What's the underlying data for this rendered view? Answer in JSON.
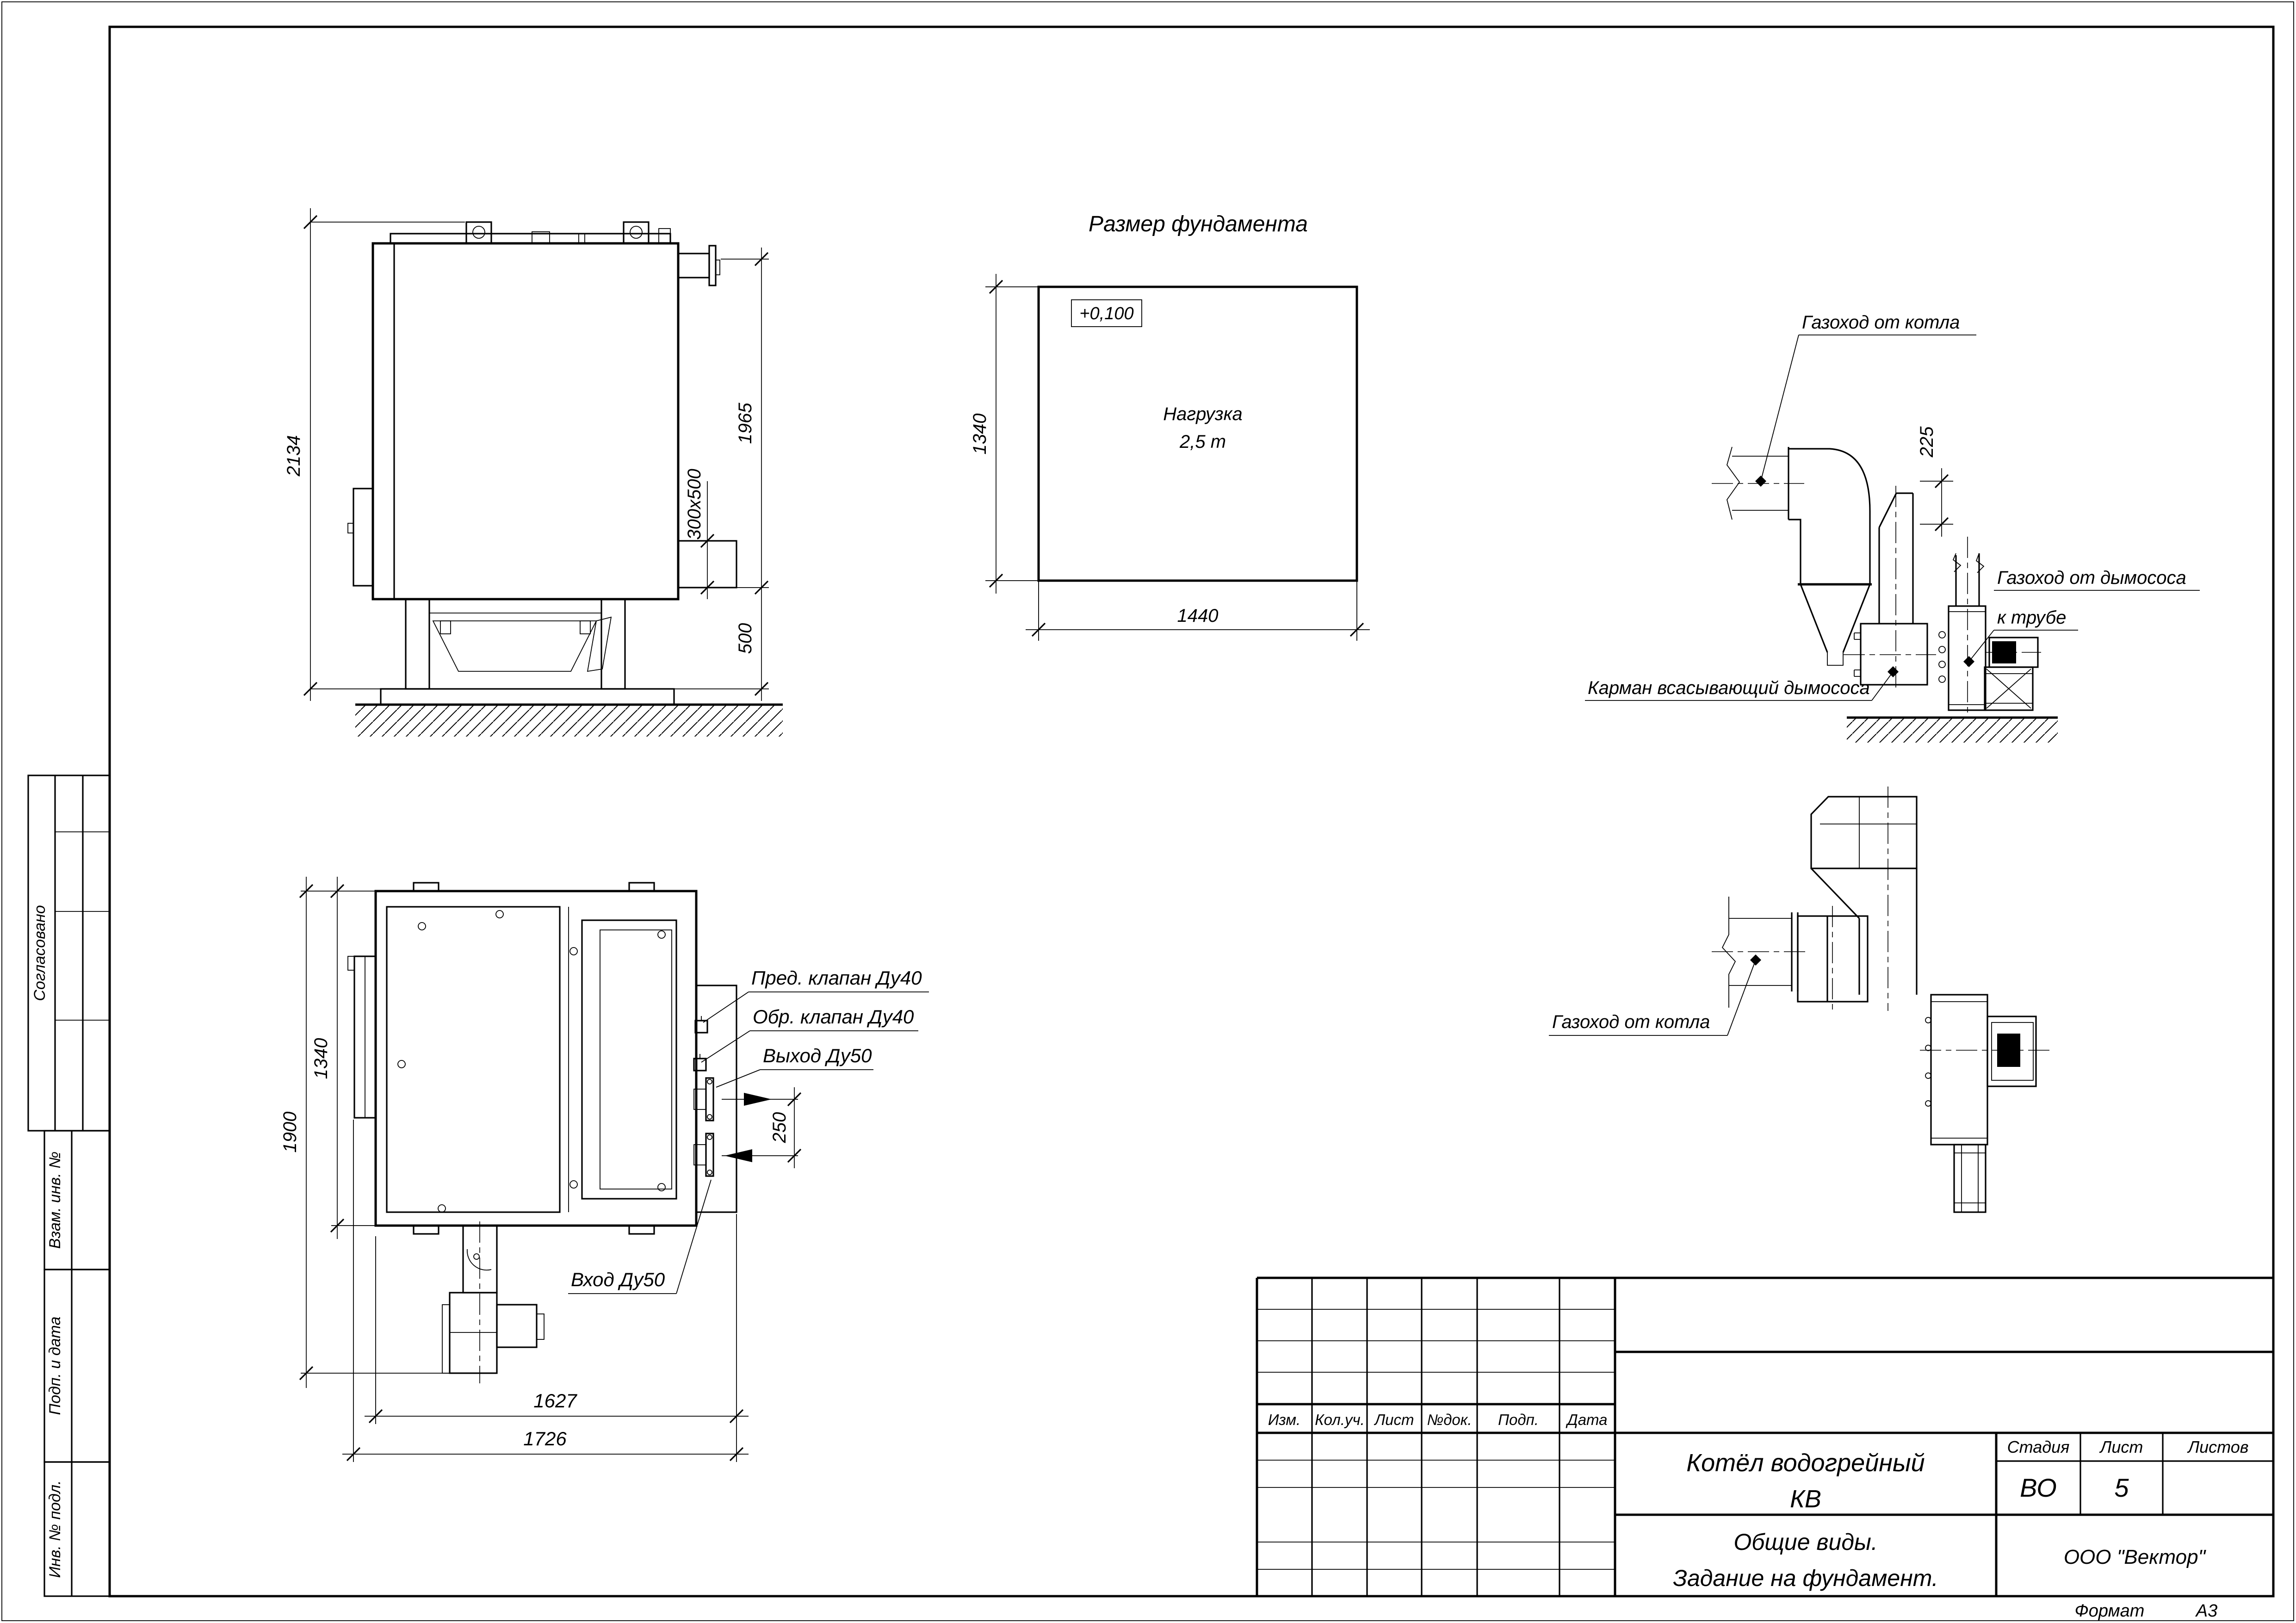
{
  "format": {
    "label": "Формат",
    "value": "А3"
  },
  "side_labels": {
    "approved": "Согласовано",
    "replace_inv": "Взам. инв. №",
    "sign_date": "Подп. и дата",
    "inv_orig": "Инв. № подл."
  },
  "title_block": {
    "change_table_headers": [
      "Изм.",
      "Кол.уч.",
      "Лист",
      "№док.",
      "Подп.",
      "Дата"
    ],
    "doc_title_line1": "Котёл водогрейный",
    "doc_title_line2": "КВ",
    "sheet_title_line1": "Общие виды.",
    "sheet_title_line2": "Задание на фундамент.",
    "stage_label": "Стадия",
    "sheet_label": "Лист",
    "sheets_label": "Листов",
    "stage_value": "ВО",
    "sheet_value": "5",
    "sheets_value": "",
    "company": "ООО \"Вектор\""
  },
  "views": {
    "side_view": {
      "dims": {
        "overall_height": "2134",
        "duct_section": "300х500",
        "flange_height": "1965",
        "support_height": "500"
      }
    },
    "foundation": {
      "title": "Размер фундамента",
      "elevation": "+0,100",
      "load_line1": "Нагрузка",
      "load_line2": "2,5 т",
      "dim_depth": "1340",
      "dim_width": "1440"
    },
    "flue_side": {
      "label_boiler_duct": "Газоход от котла",
      "dim_offset": "225",
      "label_fan_duct_line1": "Газоход от дымососа",
      "label_fan_duct_line2": "к трубе",
      "label_pocket": "Карман всасывающий дымососа"
    },
    "flue_plan": {
      "label_boiler_duct": "Газоход от котла"
    },
    "top_view": {
      "dims": {
        "overall_width": "1900",
        "body_width": "1340",
        "body_length": "1627",
        "overall_length": "1726",
        "nozzle_spacing": "250"
      },
      "labels": {
        "safety_valve": "Пред. клапан Ду40",
        "check_valve": "Обр. клапан Ду40",
        "outlet": "Выход Ду50",
        "inlet": "Вход Ду50"
      }
    }
  }
}
